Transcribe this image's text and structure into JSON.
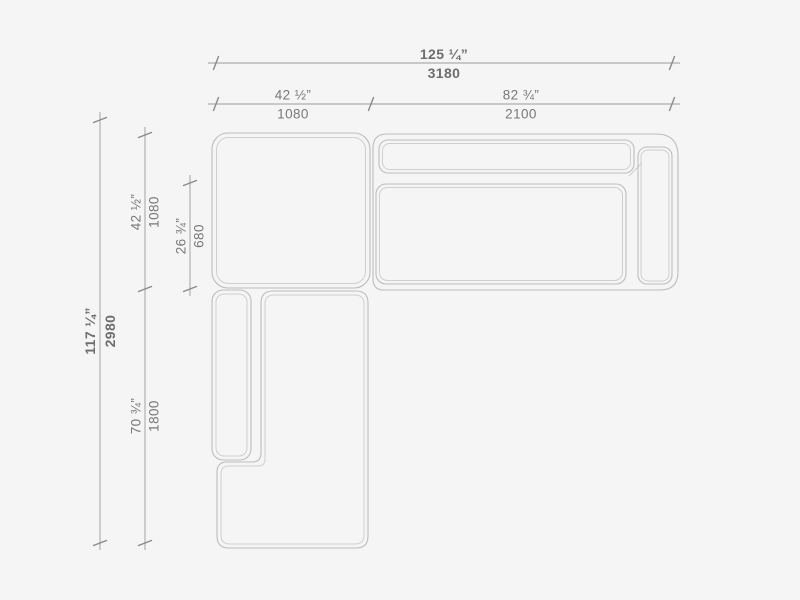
{
  "colors": {
    "background": "#f5f5f5",
    "outline": "#bdbdbd",
    "outline_inner": "#cfcfcf",
    "dimension_line": "#9a9a9a",
    "tick": "#8a8a8a",
    "label_text": "#787878",
    "label_text_bold": "#6d6d6d"
  },
  "dimensions": {
    "top_total": {
      "inches": "125 ¼”",
      "mm": "3180"
    },
    "top_left": {
      "inches": "42 ½”",
      "mm": "1080"
    },
    "top_right": {
      "inches": "82 ¾”",
      "mm": "2100"
    },
    "left_total": {
      "inches": "117 ¼”",
      "mm": "2980"
    },
    "left_upper": {
      "inches": "42 ½”",
      "mm": "1080"
    },
    "left_inner": {
      "inches": "26 ¾”",
      "mm": "680"
    },
    "left_lower": {
      "inches": "70 ¾”",
      "mm": "1800"
    }
  }
}
